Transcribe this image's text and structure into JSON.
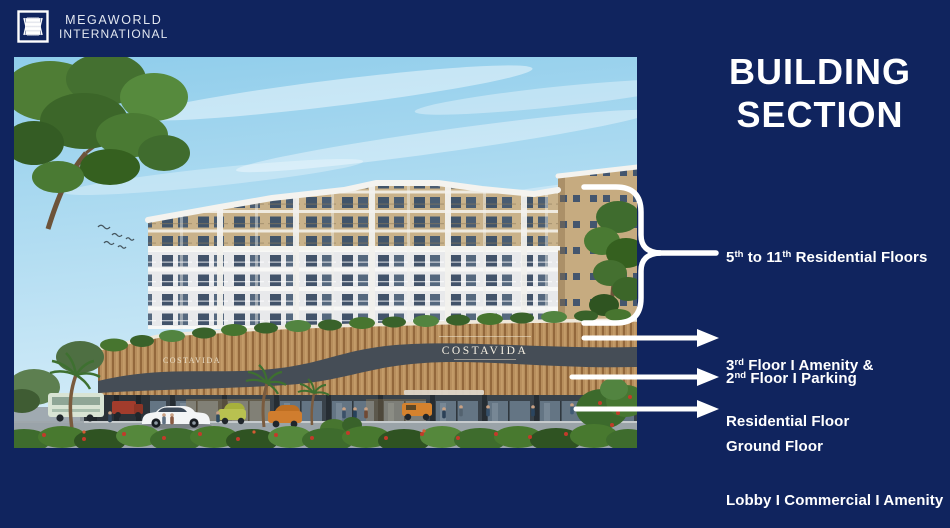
{
  "brand": {
    "line1": "MEGAWORLD",
    "line2": "INTERNATIONAL"
  },
  "title": {
    "line1": "BUILDING",
    "line2": "SECTION"
  },
  "scene": {
    "sign": "COSTAVIDA"
  },
  "annotations": {
    "residential": {
      "pre": "5",
      "sup1": "th",
      "mid": " to 11",
      "sup2": "th",
      "post": " Residential Floors"
    },
    "amenity": {
      "pre": "3",
      "sup": "rd",
      "post": " Floor I Amenity &",
      "line2": "Residential Floor"
    },
    "parking": {
      "pre": "2",
      "sup": "nd",
      "post": " Floor I Parking"
    },
    "ground": {
      "line1": "Ground Floor",
      "line2": "Lobby I Commercial I Amenity"
    }
  },
  "colors": {
    "background_navy": "#10245e",
    "text_white": "#ffffff",
    "sky_blue": "#9fd4ef",
    "facade_tan": "#c9b28a",
    "facade_white": "#e8e9eb",
    "podium_wood": "#b78e5d",
    "window_blue": "#42536a",
    "foliage_green": "#47752f",
    "flower_red": "#c23b2a"
  }
}
